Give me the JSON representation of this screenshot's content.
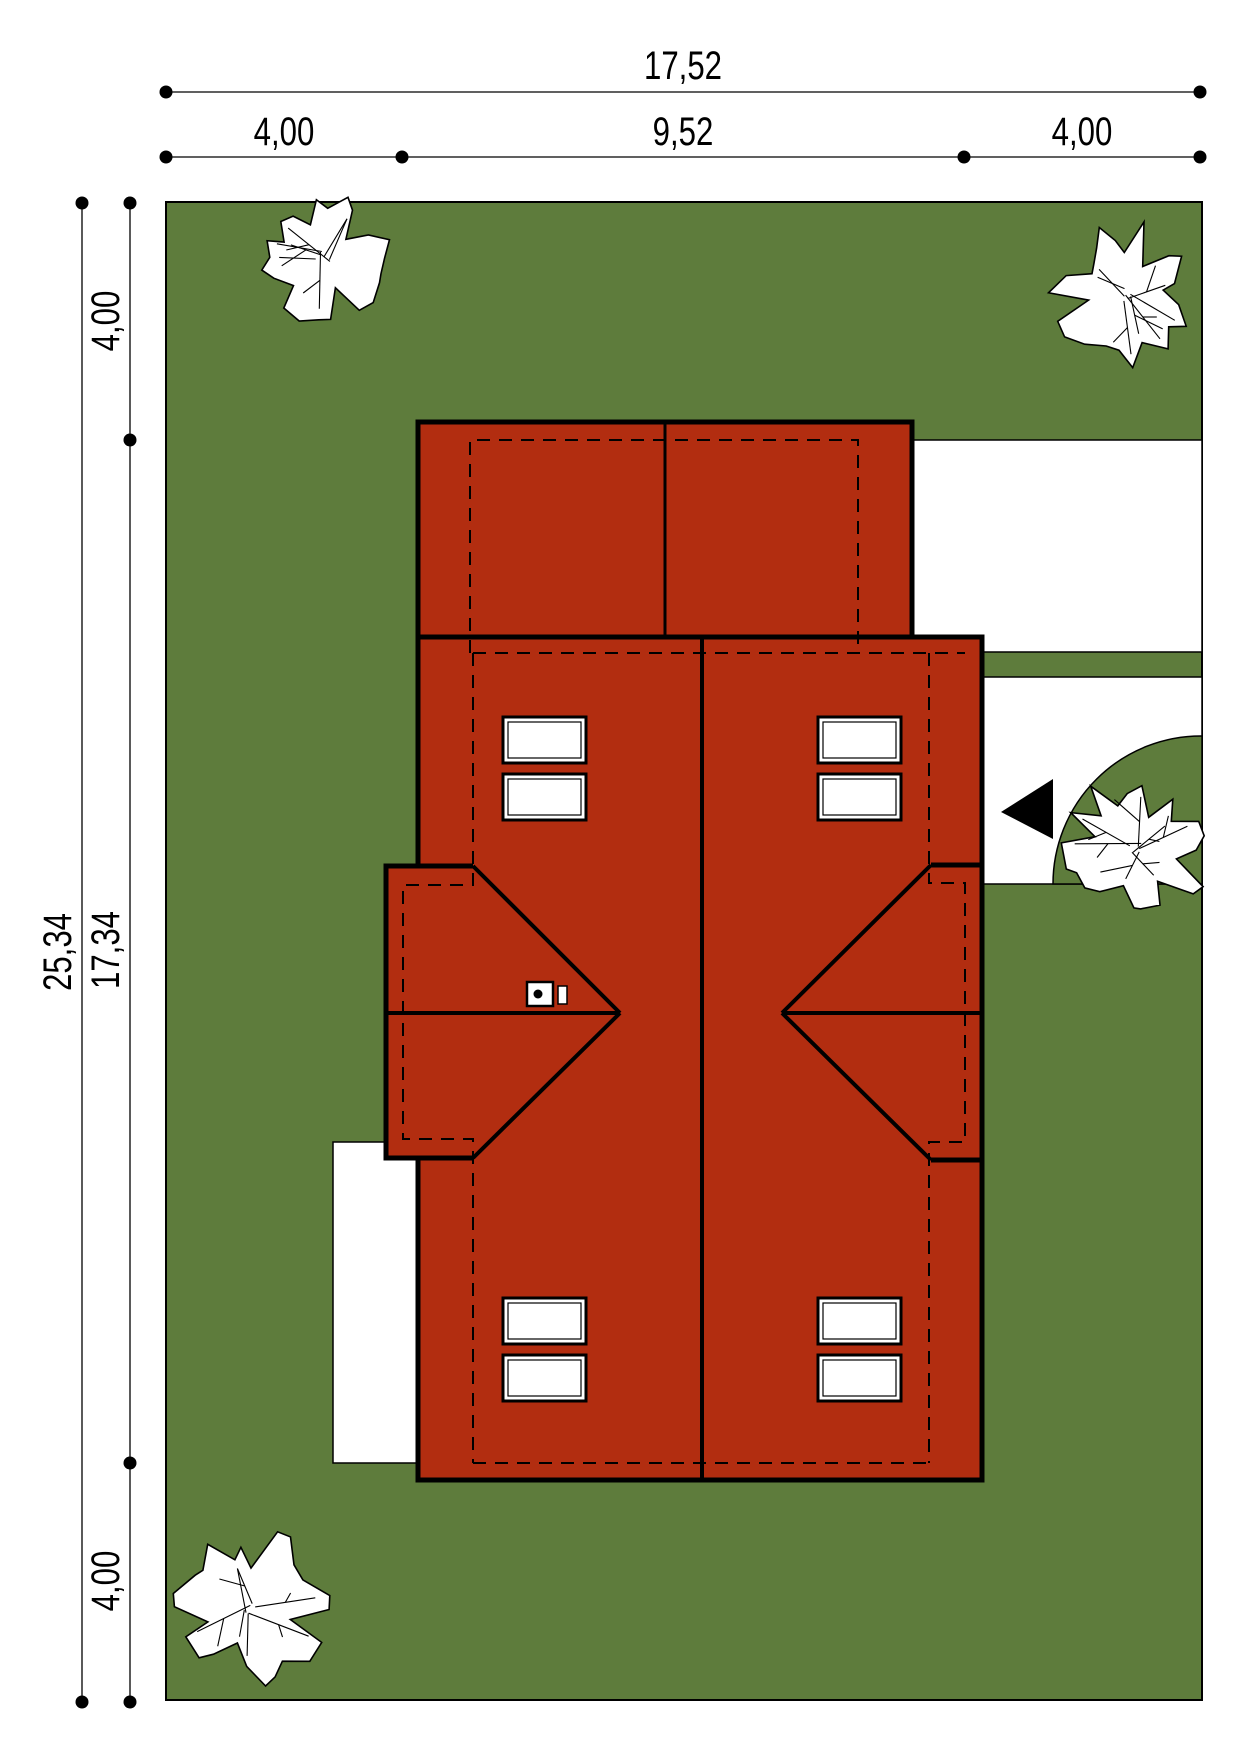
{
  "title": "site-plan-roof-view",
  "colors": {
    "lawn": "#5e7c3c",
    "roof": "#b22d10",
    "paving": "#ffffff",
    "ink": "#000000"
  },
  "dimensions": {
    "top_total": "17,52",
    "top_segments": [
      "4,00",
      "9,52",
      "4,00"
    ],
    "left_total": "25,34",
    "left_segments": [
      "4,00",
      "17,34",
      "4,00"
    ]
  },
  "labels": [
    {
      "text": "17,52",
      "x": 683,
      "y": 79,
      "rot": 0
    },
    {
      "text": "4,00",
      "x": 284,
      "y": 145,
      "rot": 0
    },
    {
      "text": "9,52",
      "x": 683,
      "y": 145,
      "rot": 0
    },
    {
      "text": "4,00",
      "x": 1082,
      "y": 145,
      "rot": 0
    },
    {
      "text": "25,34",
      "x": 71,
      "y": 952,
      "rot": -90
    },
    {
      "text": "4,00",
      "x": 119,
      "y": 321,
      "rot": -90
    },
    {
      "text": "17,34",
      "x": 119,
      "y": 950,
      "rot": -90
    },
    {
      "text": "4,00",
      "x": 119,
      "y": 1581,
      "rot": -90
    }
  ],
  "shapes": [
    {
      "type": "rect",
      "name": "plot-lawn",
      "x": 166,
      "y": 202,
      "w": 1036,
      "h": 1498,
      "fill": "lawn",
      "stroke": "ink",
      "sw": 2
    },
    {
      "type": "rect",
      "name": "terrace",
      "x": 333,
      "y": 1142,
      "w": 88,
      "h": 321,
      "fill": "paving",
      "stroke": "ink",
      "sw": 1.5
    },
    {
      "type": "rect",
      "name": "driveway-upper",
      "x": 912,
      "y": 440,
      "w": 290,
      "h": 212,
      "fill": "paving",
      "stroke": "ink",
      "sw": 1.5
    },
    {
      "type": "rect",
      "name": "driveway-lower",
      "x": 982,
      "y": 677,
      "w": 220,
      "h": 207,
      "fill": "paving",
      "stroke": "ink",
      "sw": 1.5
    },
    {
      "type": "path",
      "name": "lawn-quarter-circle",
      "d": "M1202,736 A148,148 0 0 0 1053,884 L1202,884 Z",
      "fill": "lawn",
      "stroke": "ink",
      "sw": 1.5
    },
    {
      "type": "rect",
      "name": "garage-roof",
      "x": 418,
      "y": 422,
      "w": 494,
      "h": 215,
      "fill": "roof",
      "stroke": "ink",
      "sw": 5
    },
    {
      "type": "rect",
      "name": "main-roof",
      "x": 418,
      "y": 637,
      "w": 564,
      "h": 843,
      "fill": "roof",
      "stroke": "ink",
      "sw": 5
    },
    {
      "type": "path",
      "name": "left-wing-roof",
      "d": "M473,866 L386,866 L386,1158 L473,1158",
      "fill": "roof",
      "stroke": "ink",
      "sw": 5
    },
    {
      "type": "line",
      "name": "right-notch-top-edge",
      "x1": 931,
      "y1": 865,
      "x2": 982,
      "y2": 865,
      "stroke": "ink",
      "sw": 5
    },
    {
      "type": "line",
      "name": "right-notch-bottom-edge",
      "x1": 931,
      "y1": 1160,
      "x2": 982,
      "y2": 1160,
      "stroke": "ink",
      "sw": 5
    },
    {
      "type": "line",
      "name": "left-ridge",
      "x1": 386,
      "y1": 1013,
      "x2": 620,
      "y2": 1013,
      "stroke": "ink",
      "sw": 4
    },
    {
      "type": "line",
      "name": "left-hip-upper",
      "x1": 473,
      "y1": 866,
      "x2": 620,
      "y2": 1013,
      "stroke": "ink",
      "sw": 4
    },
    {
      "type": "line",
      "name": "left-hip-lower",
      "x1": 473,
      "y1": 1158,
      "x2": 620,
      "y2": 1013,
      "stroke": "ink",
      "sw": 4
    },
    {
      "type": "line",
      "name": "right-ridge",
      "x1": 782,
      "y1": 1013,
      "x2": 982,
      "y2": 1013,
      "stroke": "ink",
      "sw": 4
    },
    {
      "type": "line",
      "name": "right-hip-upper",
      "x1": 931,
      "y1": 865,
      "x2": 782,
      "y2": 1013,
      "stroke": "ink",
      "sw": 4
    },
    {
      "type": "line",
      "name": "right-hip-lower",
      "x1": 931,
      "y1": 1160,
      "x2": 782,
      "y2": 1013,
      "stroke": "ink",
      "sw": 4
    },
    {
      "type": "line",
      "name": "party-wall-ridge",
      "x1": 702,
      "y1": 637,
      "x2": 702,
      "y2": 1480,
      "stroke": "ink",
      "sw": 4
    },
    {
      "type": "line",
      "name": "garage-ridge",
      "x1": 665,
      "y1": 422,
      "x2": 665,
      "y2": 637,
      "stroke": "ink",
      "sw": 3
    },
    {
      "type": "path",
      "name": "garage-wall-dashed",
      "d": "M470,653 L470,440 L858,440 L858,653",
      "stroke": "ink",
      "sw": 2,
      "dash": "13,9"
    },
    {
      "type": "line",
      "name": "rear-eave-dashed",
      "x1": 473,
      "y1": 653,
      "x2": 965,
      "y2": 653,
      "stroke": "ink",
      "sw": 2,
      "dash": "13,9"
    },
    {
      "type": "path",
      "name": "left-wall-dashed",
      "d": "M473,653 L473,885 L403,885 L403,1139 L473,1139 L473,1463",
      "stroke": "ink",
      "sw": 2,
      "dash": "13,9"
    },
    {
      "type": "line",
      "name": "front-wall-dashed",
      "x1": 473,
      "y1": 1463,
      "x2": 929,
      "y2": 1463,
      "stroke": "ink",
      "sw": 2,
      "dash": "13,9"
    },
    {
      "type": "path",
      "name": "right-wall-dashed",
      "d": "M929,653 L929,883 L965,883 L965,1142 L929,1142 L929,1463",
      "stroke": "ink",
      "sw": 2,
      "dash": "13,9"
    },
    {
      "type": "window",
      "name": "roof-window",
      "x": 503,
      "y": 717
    },
    {
      "type": "window",
      "name": "roof-window",
      "x": 503,
      "y": 774
    },
    {
      "type": "window",
      "name": "roof-window",
      "x": 818,
      "y": 717
    },
    {
      "type": "window",
      "name": "roof-window",
      "x": 818,
      "y": 774
    },
    {
      "type": "window",
      "name": "roof-window",
      "x": 503,
      "y": 1298
    },
    {
      "type": "window",
      "name": "roof-window",
      "x": 503,
      "y": 1355
    },
    {
      "type": "window",
      "name": "roof-window",
      "x": 818,
      "y": 1298
    },
    {
      "type": "window",
      "name": "roof-window",
      "x": 818,
      "y": 1355
    },
    {
      "type": "rect",
      "name": "chimney",
      "x": 527,
      "y": 982,
      "w": 26,
      "h": 24,
      "fill": "paving",
      "stroke": "ink",
      "sw": 2.5
    },
    {
      "type": "circle",
      "name": "chimney-flue",
      "cx": 538,
      "cy": 994,
      "r": 4.5,
      "fill": "ink"
    },
    {
      "type": "rect",
      "name": "roof-vent",
      "x": 558,
      "y": 986,
      "w": 9,
      "h": 18,
      "fill": "paving",
      "stroke": "ink",
      "sw": 1.5
    },
    {
      "type": "polygon",
      "name": "entrance-arrow-icon",
      "points": "1053,779 1053,839 1001,812",
      "fill": "ink"
    },
    {
      "type": "tree",
      "name": "tree-top-left",
      "cx": 322,
      "cy": 258,
      "r": 68,
      "seed": 11
    },
    {
      "type": "tree",
      "name": "tree-top-right",
      "cx": 1123,
      "cy": 293,
      "r": 72,
      "seed": 23
    },
    {
      "type": "tree",
      "name": "tree-right-middle",
      "cx": 1136,
      "cy": 848,
      "r": 76,
      "seed": 5
    },
    {
      "type": "tree",
      "name": "tree-bottom-left",
      "cx": 249,
      "cy": 1608,
      "r": 80,
      "seed": 42
    },
    {
      "type": "line",
      "name": "dim-line-top-total",
      "x1": 166,
      "y1": 92,
      "x2": 1200,
      "y2": 92,
      "stroke": "ink",
      "sw": 1.3
    },
    {
      "type": "line",
      "name": "dim-line-top-segments",
      "x1": 166,
      "y1": 157,
      "x2": 1200,
      "y2": 157,
      "stroke": "ink",
      "sw": 1.3
    },
    {
      "type": "line",
      "name": "dim-line-left-total",
      "x1": 82,
      "y1": 203,
      "x2": 82,
      "y2": 1702,
      "stroke": "ink",
      "sw": 1.3
    },
    {
      "type": "line",
      "name": "dim-line-left-segments",
      "x1": 130,
      "y1": 203,
      "x2": 130,
      "y2": 1702,
      "stroke": "ink",
      "sw": 1.3
    },
    {
      "type": "circle",
      "name": "dim-dot",
      "cx": 166,
      "cy": 92,
      "r": 6.5,
      "fill": "ink"
    },
    {
      "type": "circle",
      "name": "dim-dot",
      "cx": 1200,
      "cy": 92,
      "r": 6.5,
      "fill": "ink"
    },
    {
      "type": "circle",
      "name": "dim-dot",
      "cx": 166,
      "cy": 157,
      "r": 6.5,
      "fill": "ink"
    },
    {
      "type": "circle",
      "name": "dim-dot",
      "cx": 402,
      "cy": 157,
      "r": 6.5,
      "fill": "ink"
    },
    {
      "type": "circle",
      "name": "dim-dot",
      "cx": 964,
      "cy": 157,
      "r": 6.5,
      "fill": "ink"
    },
    {
      "type": "circle",
      "name": "dim-dot",
      "cx": 1200,
      "cy": 157,
      "r": 6.5,
      "fill": "ink"
    },
    {
      "type": "circle",
      "name": "dim-dot",
      "cx": 82,
      "cy": 203,
      "r": 6.5,
      "fill": "ink"
    },
    {
      "type": "circle",
      "name": "dim-dot",
      "cx": 82,
      "cy": 1702,
      "r": 6.5,
      "fill": "ink"
    },
    {
      "type": "circle",
      "name": "dim-dot",
      "cx": 130,
      "cy": 203,
      "r": 6.5,
      "fill": "ink"
    },
    {
      "type": "circle",
      "name": "dim-dot",
      "cx": 130,
      "cy": 440,
      "r": 6.5,
      "fill": "ink"
    },
    {
      "type": "circle",
      "name": "dim-dot",
      "cx": 130,
      "cy": 1463,
      "r": 6.5,
      "fill": "ink"
    },
    {
      "type": "circle",
      "name": "dim-dot",
      "cx": 130,
      "cy": 1702,
      "r": 6.5,
      "fill": "ink"
    }
  ]
}
